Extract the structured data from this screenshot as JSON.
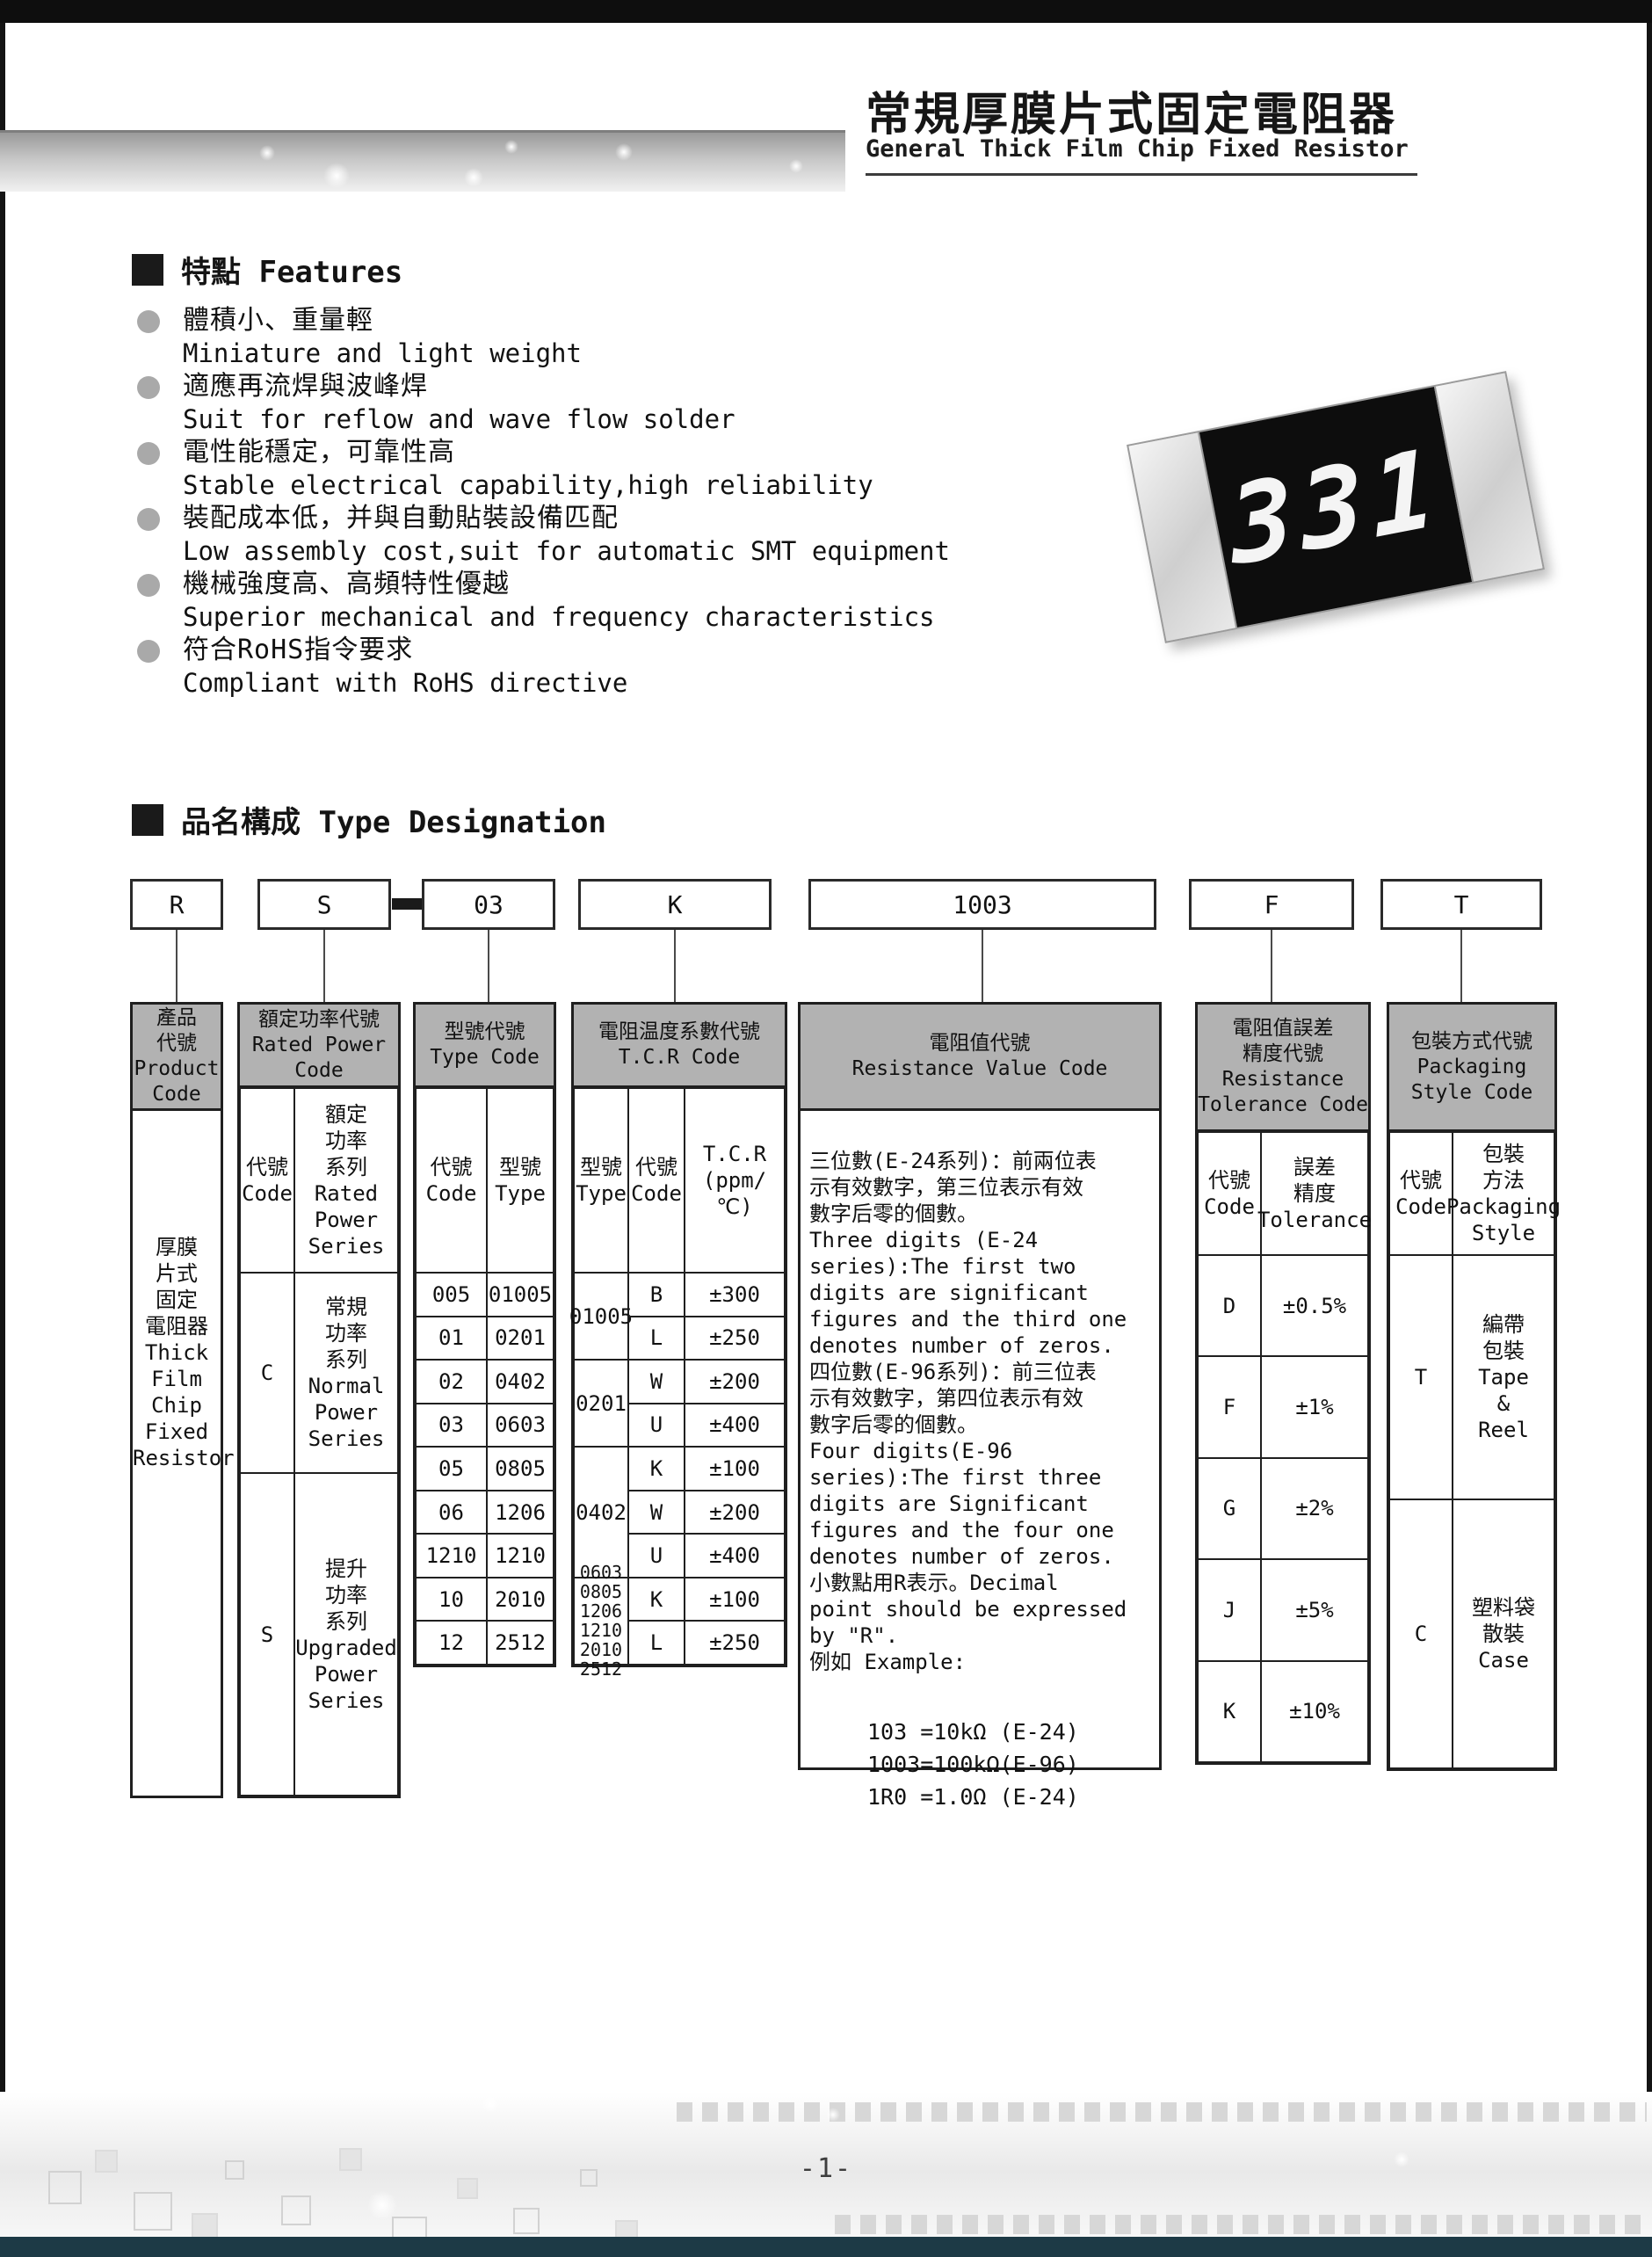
{
  "header": {
    "title_zh": "常規厚膜片式固定電阻器",
    "title_en": "General Thick Film Chip Fixed Resistor"
  },
  "features": {
    "heading": "特點 Features",
    "items": [
      {
        "zh": "體積小、重量輕",
        "en": "Miniature and light weight"
      },
      {
        "zh": "適應再流焊與波峰焊",
        "en": "Suit for reflow and wave flow solder"
      },
      {
        "zh": "電性能穩定，可靠性高",
        "en": "Stable electrical capability,high reliability"
      },
      {
        "zh": "裝配成本低，并與自動貼裝設備匹配",
        "en": "Low assembly cost,suit for automatic SMT equipment"
      },
      {
        "zh": "機械強度高、高頻特性優越",
        "en": "Superior mechanical and frequency characteristics"
      },
      {
        "zh": "符合RoHS指令要求",
        "en": "Compliant with RoHS directive"
      }
    ]
  },
  "chip": {
    "marking": "331"
  },
  "designation": {
    "heading": "品名構成  Type Designation",
    "boxes": {
      "product": "R",
      "power": "S",
      "type": "03",
      "tcr": "K",
      "resistance": "1003",
      "tolerance": "F",
      "packaging": "T"
    }
  },
  "table": {
    "product": {
      "header": "產品\n代號\nProduct\nCode",
      "body": "厚膜\n片式\n固定\n電阻器\nThick\nFilm\nChip\nFixed\nResistor"
    },
    "rated_power": {
      "header": "額定功率代號\nRated Power\nCode",
      "sub_code": "代號\nCode",
      "sub_series": "額定\n功率\n系列\nRated\nPower\nSeries",
      "rows": [
        {
          "code": "C",
          "series": "常規\n功率\n系列\nNormal\nPower\nSeries"
        },
        {
          "code": "S",
          "series": "提升\n功率\n系列\nUpgraded\nPower\nSeries"
        }
      ]
    },
    "type_code": {
      "header": "型號代號\nType Code",
      "sub_code": "代號\nCode",
      "sub_type": "型號\nType",
      "rows": [
        [
          "005",
          "01005"
        ],
        [
          "01",
          "0201"
        ],
        [
          "02",
          "0402"
        ],
        [
          "03",
          "0603"
        ],
        [
          "05",
          "0805"
        ],
        [
          "06",
          "1206"
        ],
        [
          "1210",
          "1210"
        ],
        [
          "10",
          "2010"
        ],
        [
          "12",
          "2512"
        ]
      ]
    },
    "tcr": {
      "header": "電阻温度系數代號\nT.C.R Code",
      "sub_type": "型號\nType",
      "sub_code": "代號\nCode",
      "sub_value": "T.C.R\n(ppm/℃)",
      "groups": [
        {
          "type": "01005",
          "rows": [
            [
              "B",
              "±300"
            ],
            [
              "L",
              "±250"
            ]
          ]
        },
        {
          "type": "0201",
          "rows": [
            [
              "W",
              "±200"
            ],
            [
              "U",
              "±400"
            ]
          ]
        },
        {
          "type": "0402",
          "rows": [
            [
              "K",
              "±100"
            ],
            [
              "W",
              "±200"
            ],
            [
              "U",
              "±400"
            ]
          ]
        },
        {
          "type": "0603\n0805\n1206\n1210\n2010\n2512",
          "rows": [
            [
              "K",
              "±100"
            ],
            [
              "L",
              "±250"
            ]
          ]
        }
      ]
    },
    "resistance": {
      "header": "電阻值代號\nResistance Value Code",
      "body": "三位數(E-24系列)：前兩位表\n示有效數字，第三位表示有效\n數字后零的個數。\nThree digits (E-24\nseries):The first two\ndigits are significant\nfigures and the third one\ndenotes number of zeros.\n四位數(E-96系列)：前三位表\n示有效數字，第四位表示有效\n數字后零的個數。\nFour digits(E-96\nseries):The first three\ndigits are Significant\nfigures and the four one\ndenotes number of zeros.\n小數點用R表示。Decimal\npoint should be expressed\nby \"R\".\n例如 Example:",
      "examples": "103 =10kΩ (E-24)\n1003=100kΩ(E-96)\n1R0 =1.0Ω  (E-24)"
    },
    "tolerance": {
      "header": "電阻值誤差\n精度代號\nResistance\nTolerance Code",
      "sub_code": "代號\nCode",
      "sub_tol": "誤差\n精度\nTolerance",
      "rows": [
        [
          "D",
          "±0.5%"
        ],
        [
          "F",
          "±1%"
        ],
        [
          "G",
          "±2%"
        ],
        [
          "J",
          "±5%"
        ],
        [
          "K",
          "±10%"
        ]
      ]
    },
    "packaging": {
      "header": "包裝方式代號\nPackaging\nStyle Code",
      "sub_code": "代號\nCode",
      "sub_style": "包裝\n方法\nPackaging\nStyle",
      "rows": [
        {
          "code": "T",
          "style": "編帶\n包裝\nTape\n&\nReel"
        },
        {
          "code": "C",
          "style": "塑料袋\n散裝\nCase"
        }
      ]
    }
  },
  "footer": {
    "page_number": "-1-"
  }
}
